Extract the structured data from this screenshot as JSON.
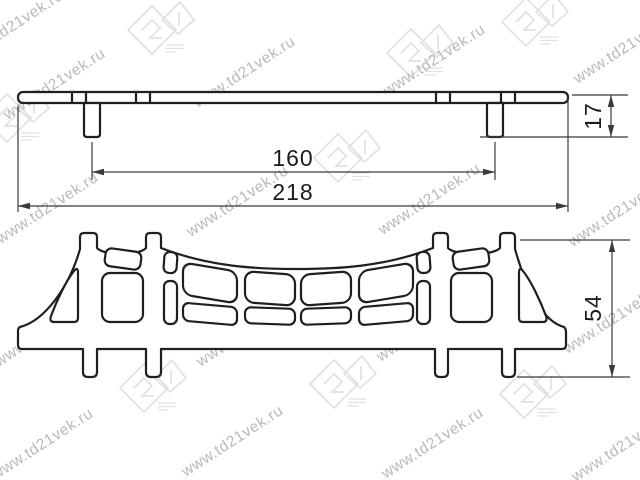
{
  "drawing": {
    "type": "technical-drawing",
    "subject": "bridge-shaped furniture handle, two projection views",
    "dimensions": {
      "hole_spacing": "160",
      "overall_length": "218",
      "profile_height": "17",
      "front_height": "54"
    },
    "watermark": {
      "text": "www.td21vek.ru",
      "logo": "21"
    },
    "colors": {
      "line": "#1f1f1f",
      "dimension": "#3a3a3a",
      "watermark": "#adadad",
      "background": "#ffffff"
    }
  }
}
